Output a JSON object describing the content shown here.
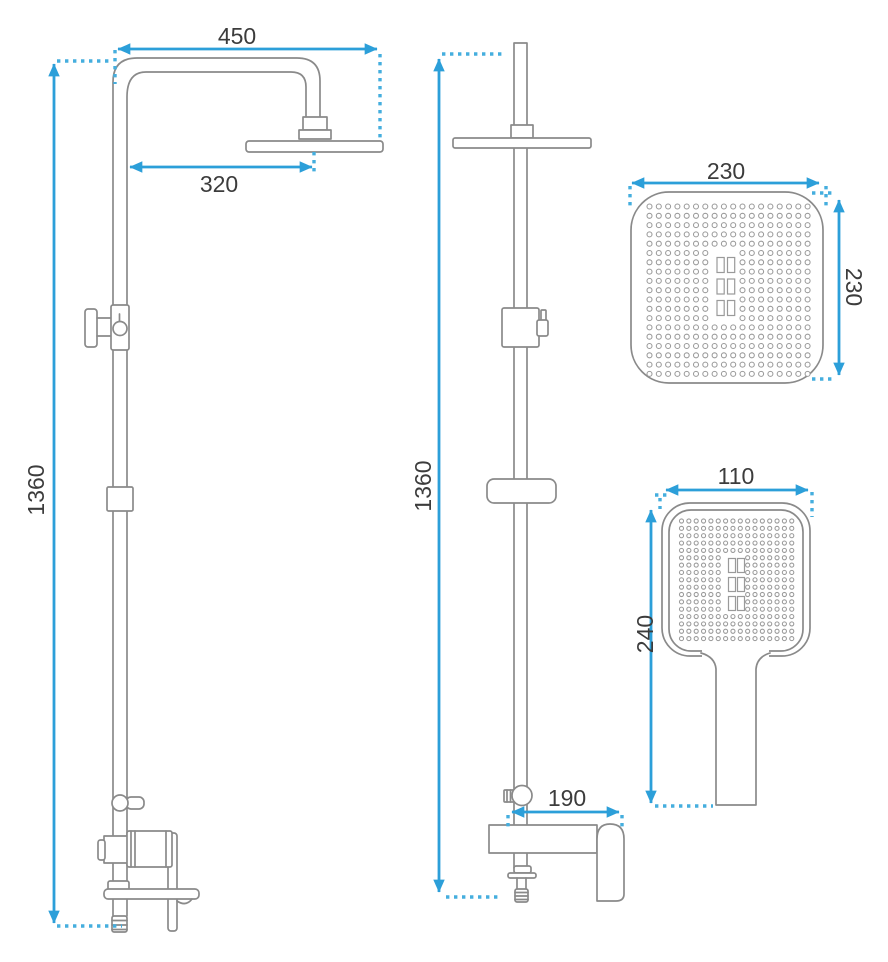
{
  "dimension_labels": {
    "front_height": "1360",
    "front_arm_width": "450",
    "front_head_offset": "320",
    "side_height": "1360",
    "side_spout_reach": "190",
    "overhead_width": "230",
    "overhead_depth": "230",
    "handshower_width": "110",
    "handshower_length": "240"
  },
  "colors": {
    "dimension_line": "#2C9FD9",
    "extension_dots": "#45AEDE",
    "product_outline": "#8A8A8A",
    "label_text": "#3C3C3C",
    "background": "#FFFFFF"
  }
}
